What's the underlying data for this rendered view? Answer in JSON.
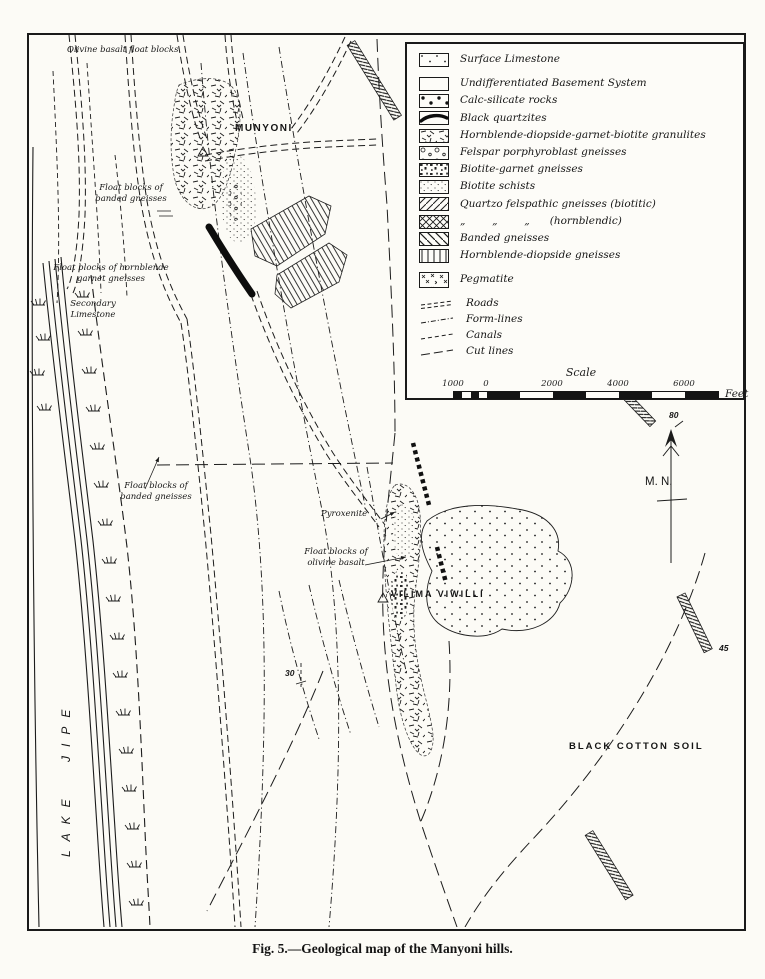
{
  "figure": {
    "caption": "Fig. 5.—Geological map of the Manyoni hills."
  },
  "legend": {
    "items": [
      {
        "key": "surface-limestone",
        "label": "Surface Limestone"
      },
      {
        "key": "undifferentiated-basement",
        "label": "Undifferentiated Basement System"
      },
      {
        "key": "calc-silicate",
        "label": "Calc-silicate rocks"
      },
      {
        "key": "black-quartzites",
        "label": "Black quartzites"
      },
      {
        "key": "hbl-diopside-garnet-biotite-granulites",
        "label": "Hornblende-diopside-garnet-biotite granulites"
      },
      {
        "key": "felspar-porphyroblast-gneisses",
        "label": "Felspar porphyroblast gneisses"
      },
      {
        "key": "biotite-garnet-gneisses",
        "label": "Biotite-garnet gneisses"
      },
      {
        "key": "biotite-schists",
        "label": "Biotite schists"
      },
      {
        "key": "quartzo-felspathic-biotitic",
        "label": "Quartzo felspathic gneisses (biotitic)"
      },
      {
        "key": "quartzo-felspathic-hornblendic",
        "label": "„        „        „      (hornblendic)"
      },
      {
        "key": "banded-gneisses",
        "label": "Banded gneisses"
      },
      {
        "key": "hornblende-diopside-gneisses",
        "label": "Hornblende-diopside gneisses"
      },
      {
        "key": "pegmatite",
        "label": "Pegmatite"
      }
    ],
    "line_items": [
      {
        "key": "roads",
        "label": "Roads"
      },
      {
        "key": "form-lines",
        "label": "Form-lines"
      },
      {
        "key": "canals",
        "label": "Canals"
      },
      {
        "key": "cut-lines",
        "label": "Cut lines"
      }
    ],
    "scale": {
      "title": "Scale",
      "ticks": [
        "1000",
        "0",
        "2000",
        "4000",
        "6000"
      ],
      "unit": "Feet"
    }
  },
  "map": {
    "labels": {
      "olivine_basalt_float": "Olivine basalt float blocks",
      "munyoni": "MUNYONI",
      "float_banded_1a": "Float blocks of",
      "float_banded_1b": "banded gneisses",
      "float_hornblende_a": "Float blocks of hornblende",
      "float_hornblende_b": "garnet gneisses",
      "secondary_limestone_a": "Secondary",
      "secondary_limestone_b": "Limestone",
      "float_banded_2a": "Float blocks of",
      "float_banded_2b": "banded gneisses",
      "pyroxenite": "Pyroxenite",
      "float_olivine_a": "Float blocks of",
      "float_olivine_b": "olivine basalt",
      "vilima_viwili": "VILIMA VIWILLI",
      "black_cotton_soil": "BLACK COTTON SOIL",
      "lake_jipe": "LAKE JIPE",
      "magnetic_north": "M. N.",
      "dip_80": "80",
      "dip_45": "45",
      "dip_30": "30"
    },
    "ink_color": "#1a1a1a",
    "paper_color": "#fcfbf6"
  }
}
